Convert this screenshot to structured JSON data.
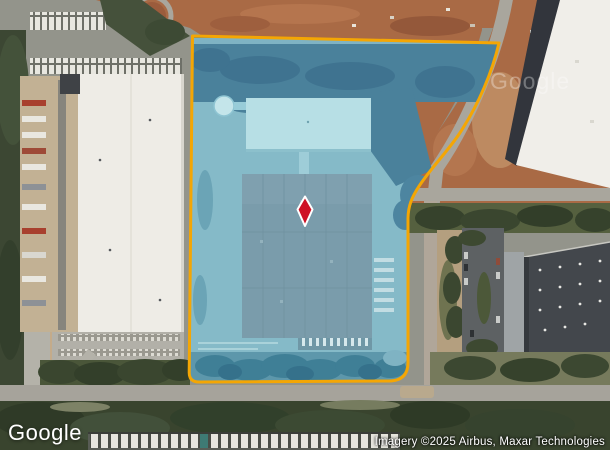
{
  "map": {
    "google_logo": "Google",
    "watermark": "Google",
    "attribution": "Imagery ©2025 Airbus, Maxar Technologies",
    "icons": {
      "marker": "diamond-pin-icon"
    },
    "colors": {
      "parcel_boundary": "#F4A604",
      "parcel_fill_teal": "#85BAC8",
      "pin_red": "#CE1126",
      "pin_outline": "#FFFFFF"
    }
  }
}
